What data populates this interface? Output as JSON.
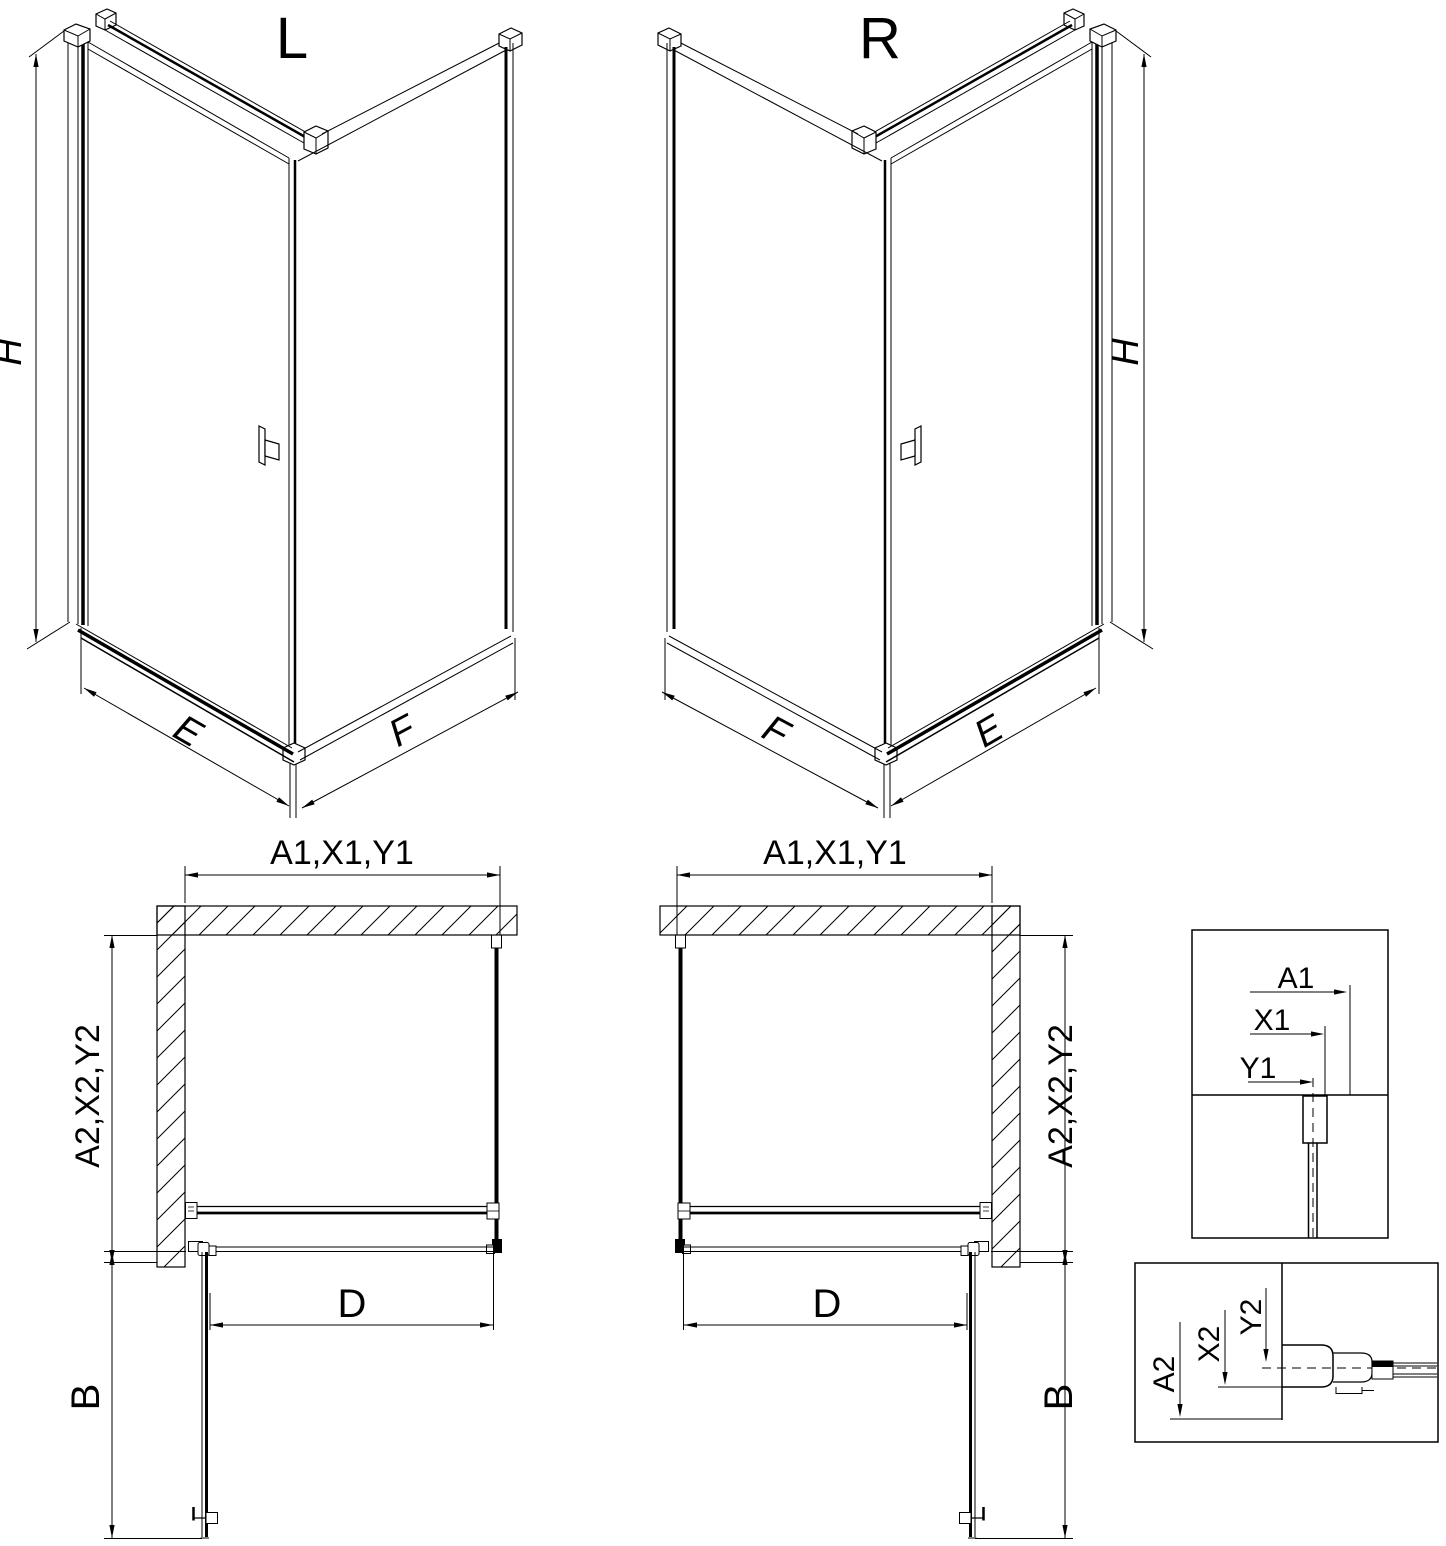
{
  "page": {
    "background": "#ffffff",
    "line_color": "#000000"
  },
  "iso_left": {
    "title": "L",
    "dims": {
      "height": "H",
      "door_side": "E",
      "fixed_side": "F"
    }
  },
  "iso_right": {
    "title": "R",
    "dims": {
      "height": "H",
      "door_side": "E",
      "fixed_side": "F"
    }
  },
  "plan_left": {
    "dims": {
      "top_width": "A1,X1,Y1",
      "side_depth": "A2,X2,Y2",
      "opening_width": "D",
      "door_projection": "B"
    }
  },
  "plan_right": {
    "dims": {
      "top_width": "A1,X1,Y1",
      "side_depth": "A2,X2,Y2",
      "opening_width": "D",
      "door_projection": "B"
    }
  },
  "detail_width_box": {
    "dims": {
      "a1": "A1",
      "x1": "X1",
      "y1": "Y1"
    }
  },
  "detail_depth_box": {
    "dims": {
      "a2": "A2",
      "x2": "X2",
      "y2": "Y2"
    }
  }
}
